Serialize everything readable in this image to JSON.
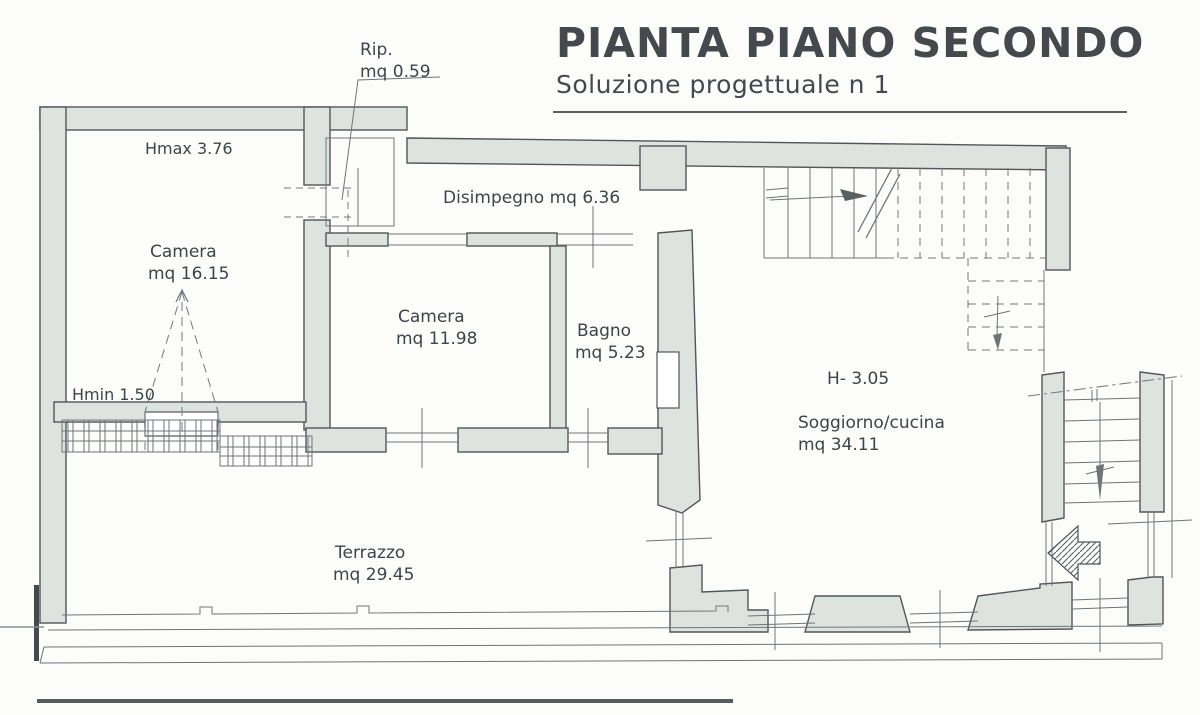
{
  "title": {
    "main": "PIANTA PIANO SECONDO",
    "subtitle": "Soluzione progettuale n 1"
  },
  "labels": {
    "rip_name": "Rip.",
    "rip_area": "mq 0.59",
    "hmax": "Hmax  3.76",
    "camera1_name": "Camera",
    "camera1_area": "mq 16.15",
    "disimpegno": "Disimpegno mq 6.36",
    "camera2_name": "Camera",
    "camera2_area": "mq 11.98",
    "bagno_name": "Bagno",
    "bagno_area": "mq 5.23",
    "hmin": "Hmin 1.50",
    "h_soggiorno": "H- 3.05",
    "soggiorno_name": "Soggiorno/cucina",
    "soggiorno_area": "mq 34.11",
    "terrazzo_name": "Terrazzo",
    "terrazzo_area": "mq 29.45"
  },
  "colors": {
    "wall_fill": "#dfe3e0",
    "wall_stroke": "#51565a",
    "thin_line": "#6f7477",
    "text": "#3f4448"
  }
}
